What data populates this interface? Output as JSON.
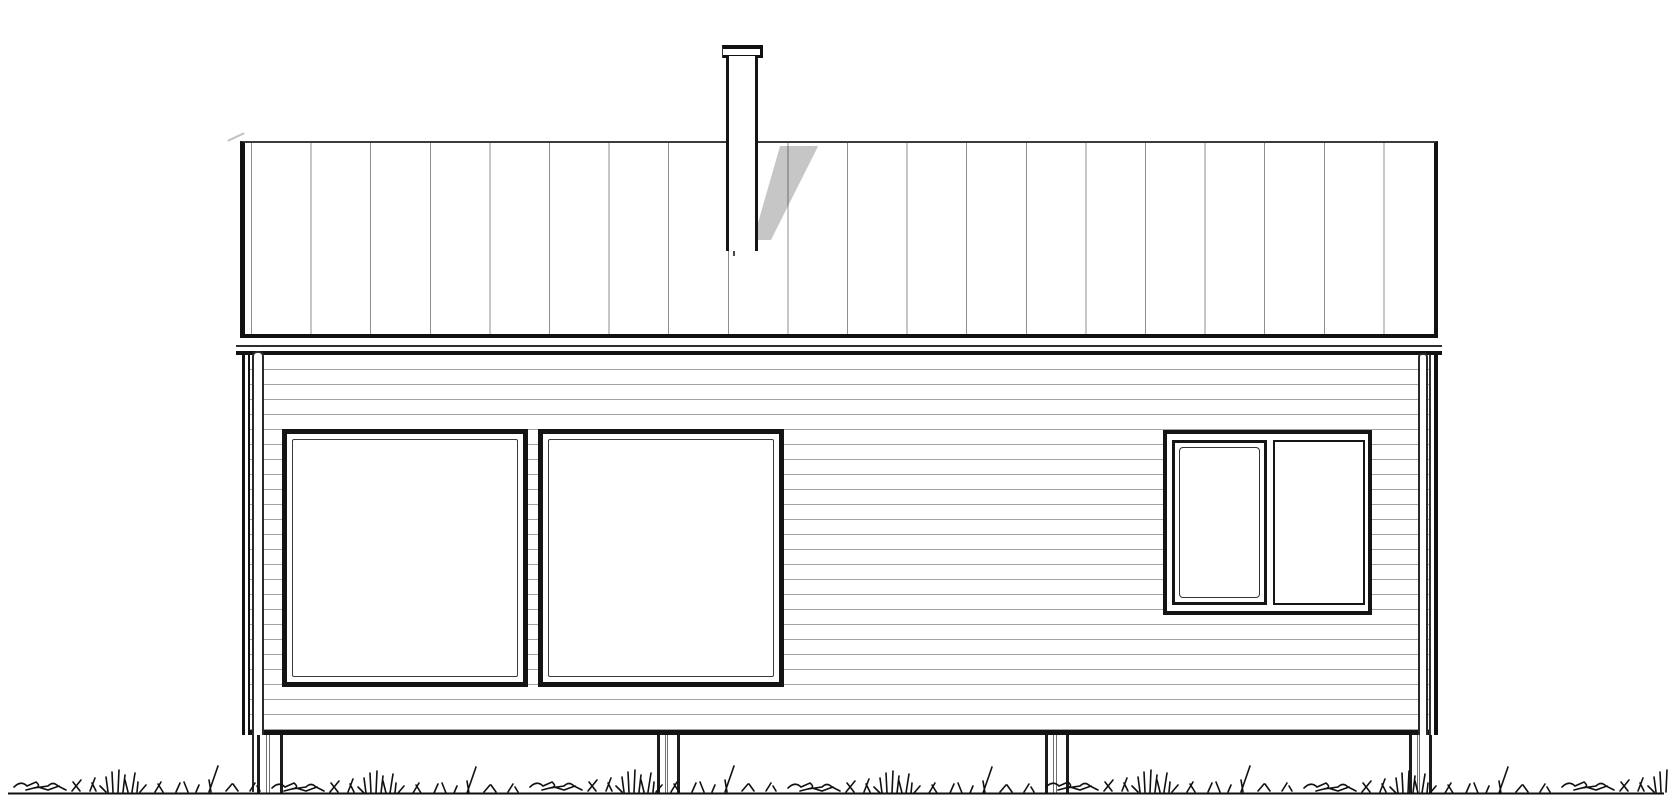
{
  "meta": {
    "type": "architectural-elevation-drawing",
    "view": "house facade elevation, black line drawing on white",
    "visible_text": "none"
  },
  "palette": {
    "line": "#141414",
    "roof_seam_line": "#8f8f8f",
    "siding_line": "#a3a3a3",
    "chimney_shadow": "#c4c4c4",
    "background": "#ffffff"
  },
  "components": {
    "roof": {
      "label": "standing-seam roof band with vertical seams",
      "seam_count": 20
    },
    "chimney": {
      "label": "chimney flue with cap, casts diagonal shadow on roof"
    },
    "fascia": {
      "label": "double eave trim lines under roof"
    },
    "wall": {
      "label": "horizontal lap siding wall",
      "siding_line_spacing_px": 15
    },
    "windows": [
      {
        "label": "large square picture window, left"
      },
      {
        "label": "large square picture window, center-left"
      },
      {
        "label": "smaller double window, right",
        "panes": [
          "operable casement with inner sash line",
          "fixed pane"
        ]
      }
    ],
    "downspouts": [
      {
        "side": "left"
      },
      {
        "side": "right"
      }
    ],
    "corner_boards": [
      {
        "side": "left"
      },
      {
        "side": "right"
      }
    ],
    "foundation_posts": {
      "count": 4
    },
    "ground": {
      "label": "hand-drawn grass tufts over ground baseline"
    }
  }
}
